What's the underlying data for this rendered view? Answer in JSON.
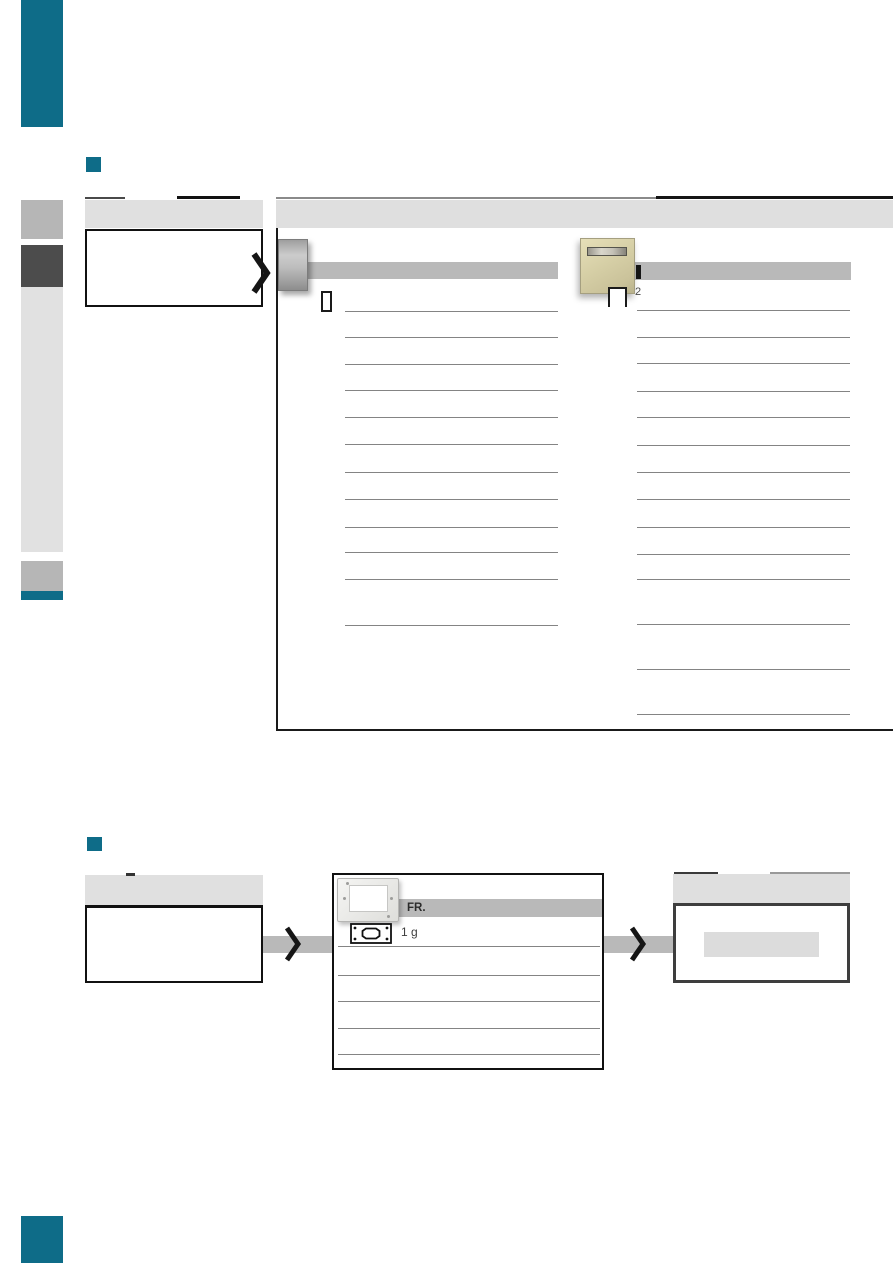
{
  "page": {
    "background": "#ffffff"
  },
  "colors": {
    "teal_accent": "#0e6c88",
    "header_gray": "#e0e0e0",
    "shade_bar_gray": "#b9b9b9",
    "sidebar_gray_medium": "#b6b6b6",
    "sidebar_gray_dark": "#4c4c4c",
    "sidebar_gray_light": "#e1e1e1",
    "row_line_gray": "#848484",
    "box_border_dark": "#1a1a1a",
    "result_box_border": "#3e3e3e"
  },
  "section1": {
    "panel": {
      "column_right": {
        "badge": "2"
      }
    }
  },
  "section2": {
    "middle_box": {
      "bar_label": "FR.",
      "qty_label": "1 g"
    }
  },
  "icons": {
    "arrow": "chevron-right-icon",
    "module_single": "single-module-outline-icon",
    "module_double": "double-module-outline-icon",
    "flush_box": "flush-mounting-box-icon"
  }
}
